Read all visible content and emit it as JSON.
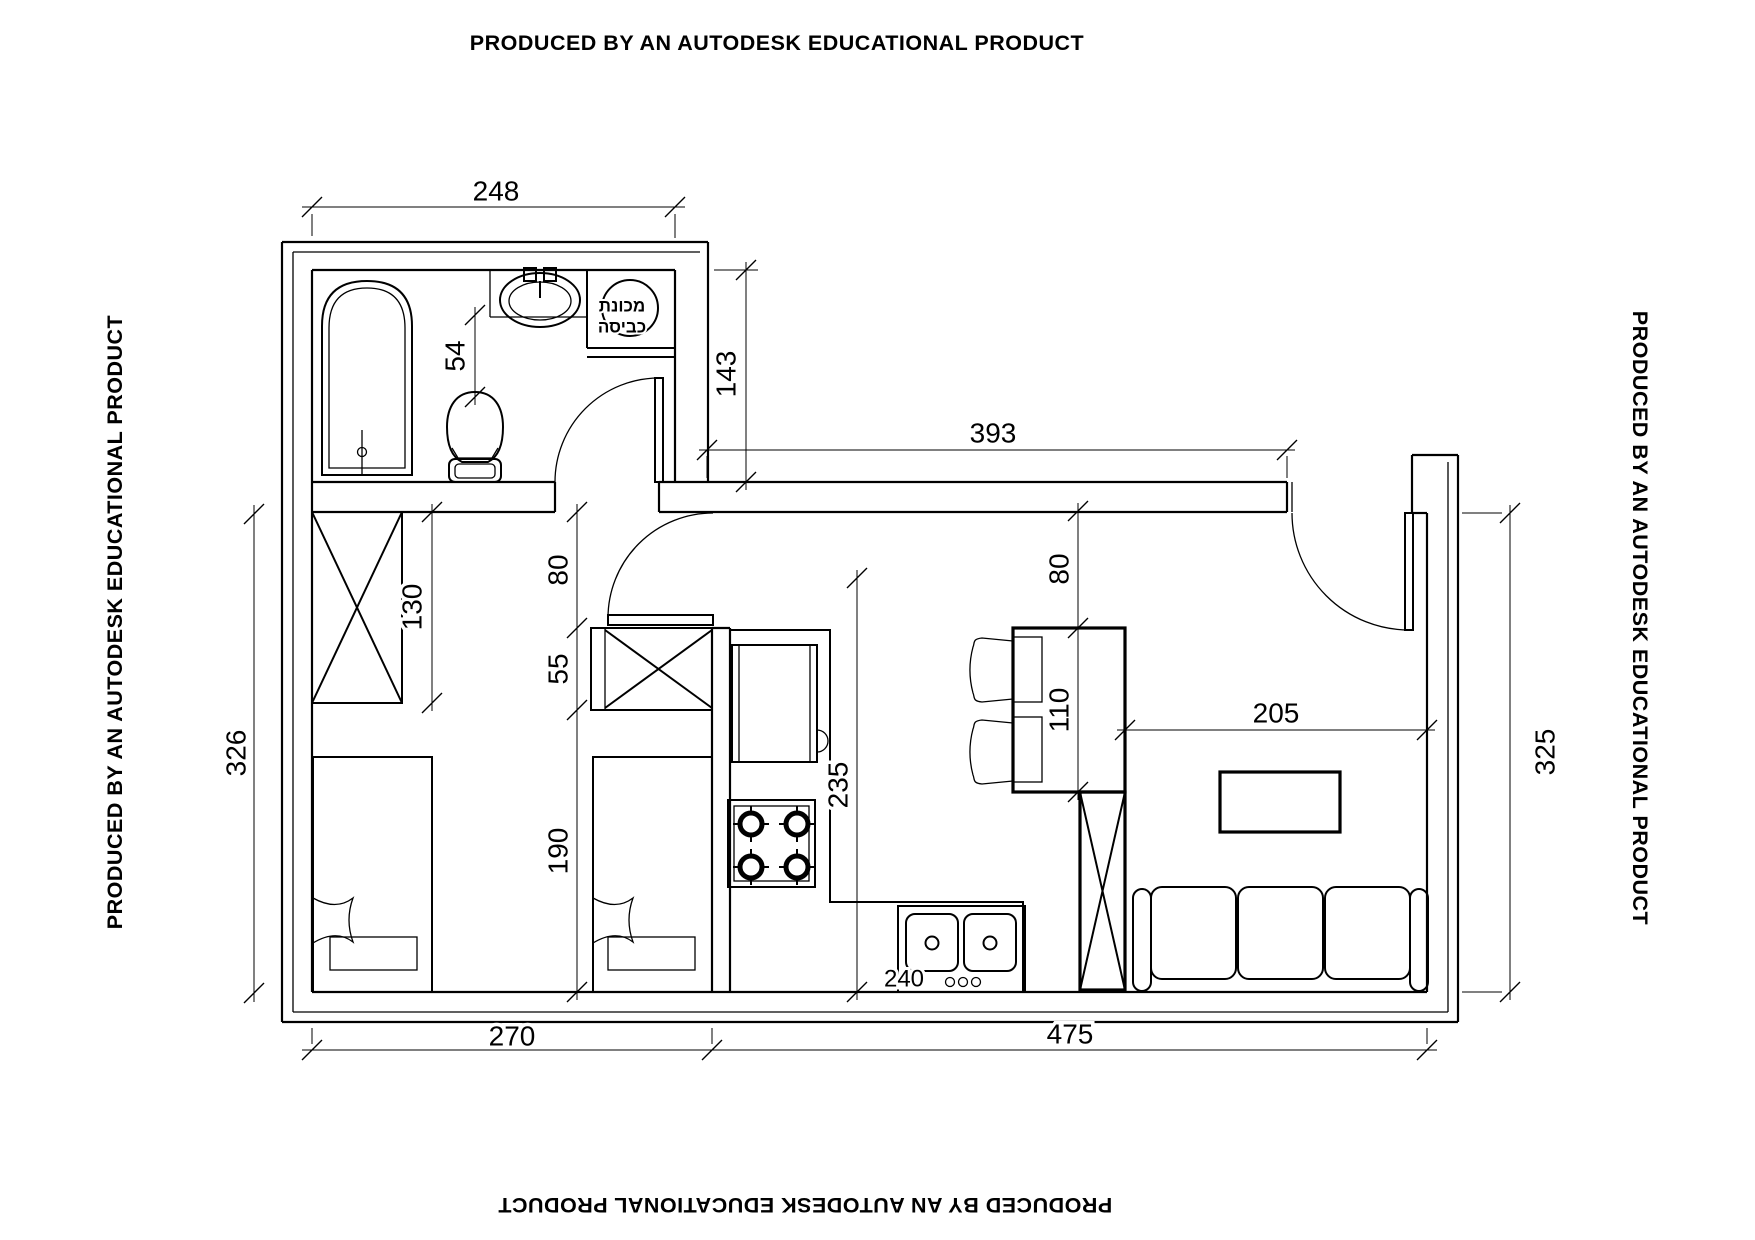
{
  "banners": {
    "text": "PRODUCED BY AN AUTODESK EDUCATIONAL PRODUCT"
  },
  "fixtures": {
    "washing_machine_label_line1": "מכונת",
    "washing_machine_label_line2": "כביסה"
  },
  "dimensions": {
    "bathroom_width": "248",
    "toilet_clearance": "54",
    "entry_recess_depth": "143",
    "living_top_width": "393",
    "wardrobe_length": "130",
    "bedroom_door_width": "80",
    "closet_depth": "55",
    "bed_zone_length": "190",
    "bedroom_depth": "326",
    "kitchen_door_width": "80",
    "table_length": "110",
    "counter_run": "235",
    "living_width": "205",
    "living_depth": "325",
    "bedroom_width": "270",
    "main_zone_width": "475",
    "sink_counter": "240"
  }
}
